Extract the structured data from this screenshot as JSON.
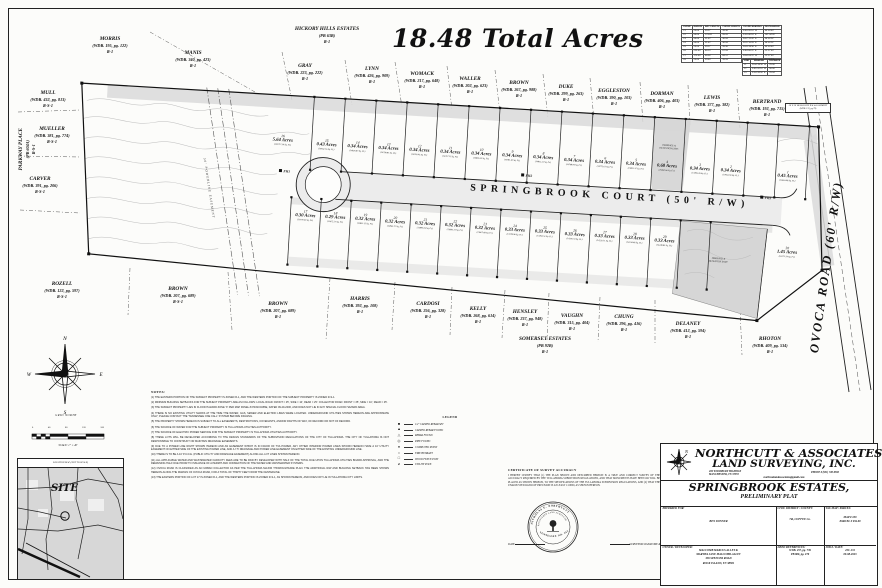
{
  "sheet": {
    "acres_title": "18.48 Total Acres"
  },
  "plat": {
    "street_label": "SPRINGBROOK COURT (50' R/W)",
    "road_label": "OVOCA ROAD (60' R/W)",
    "powerline_label": "50' POWERLINE EASEMENT",
    "bellsouth_note": "20' X 30' BELLSOUTH R/W & EASEMENT (WDB. 133, pg 79)",
    "detention_label_1": "DRAINAGE &",
    "detention_label_2": "DETENTION ESMT.",
    "lot4_esmt_1": "DRAINAGE &",
    "lot4_esmt_2": "DETENTION ESMT.",
    "hydrants": [
      {
        "label": "FH1",
        "x": 204,
        "y": 77
      },
      {
        "label": "FH2",
        "x": 446,
        "y": 67
      },
      {
        "label": "FH3",
        "x": 686,
        "y": 75
      }
    ],
    "north_lots": [
      {
        "num": "16",
        "acres": "5.64 Acres",
        "sqft": "(245717.36 Sq. Ft.)",
        "x": 206,
        "y": 42
      },
      {
        "num": "15",
        "acres": "0.43 Acres",
        "sqft": "(18652.16 Sq. Ft.)",
        "x": 250,
        "y": 44
      },
      {
        "num": "14",
        "acres": "0.34 Acres",
        "sqft": "(14826.87 Sq. Ft.)",
        "x": 281,
        "y": 44
      },
      {
        "num": "13",
        "acres": "0.34 Acres",
        "sqft": "(14799.81 Sq. Ft.)",
        "x": 312,
        "y": 44
      },
      {
        "num": "12",
        "acres": "0.34 Acres",
        "sqft": "(14790.43 Sq. Ft.)",
        "x": 343,
        "y": 44
      },
      {
        "num": "11",
        "acres": "0.34 Acres",
        "sqft": "(14757.11 Sq. Ft.)",
        "x": 374,
        "y": 44
      },
      {
        "num": "10",
        "acres": "0.34 Acres",
        "sqft": "(14806.55 Sq. Ft.)",
        "x": 405,
        "y": 44
      },
      {
        "num": "9",
        "acres": "0.34 Acres",
        "sqft": "(14781.40 Sq. Ft.)",
        "x": 436,
        "y": 44
      },
      {
        "num": "8",
        "acres": "0.34 Acres",
        "sqft": "(14812.22 Sq. Ft.)",
        "x": 467,
        "y": 44
      },
      {
        "num": "7",
        "acres": "0.34 Acres",
        "sqft": "(14768.94 Sq. Ft.)",
        "x": 498,
        "y": 45
      },
      {
        "num": "6",
        "acres": "0.34 Acres",
        "sqft": "(14775.61 Sq. Ft.)",
        "x": 529,
        "y": 45
      },
      {
        "num": "5",
        "acres": "0.34 Acres",
        "sqft": "(14802.37 Sq. Ft.)",
        "x": 560,
        "y": 45
      },
      {
        "num": "4",
        "acres": "0.68 Acres",
        "sqft": "(29490.66 Sq. Ft.)",
        "x": 591,
        "y": 45
      },
      {
        "num": "3",
        "acres": "0.34 Acres",
        "sqft": "(14785.09 Sq. Ft.)",
        "x": 624,
        "y": 46
      },
      {
        "num": "2",
        "acres": "0.34 Acres",
        "sqft": "(14952.93 Sq. Ft.)",
        "x": 655,
        "y": 46
      },
      {
        "num": "1",
        "acres": "0.45 Acres",
        "sqft": "(19663.98 Sq. Ft.)",
        "x": 712,
        "y": 48
      }
    ],
    "south_lots": [
      {
        "num": "17",
        "acres": "0.30 Acres",
        "sqft": "(13079.43 Sq. Ft.)",
        "x": 233,
        "y": 116
      },
      {
        "num": "18",
        "acres": "0.29 Acres",
        "sqft": "(12675.27 Sq. Ft.)",
        "x": 263,
        "y": 116
      },
      {
        "num": "19",
        "acres": "0.32 Acres",
        "sqft": "(13852.15 Sq. Ft.)",
        "x": 293,
        "y": 116
      },
      {
        "num": "20",
        "acres": "0.32 Acres",
        "sqft": "(13865.72 Sq. Ft.)",
        "x": 323,
        "y": 117
      },
      {
        "num": "21",
        "acres": "0.32 Acres",
        "sqft": "(13880.09 Sq. Ft.)",
        "x": 353,
        "y": 117
      },
      {
        "num": "22",
        "acres": "0.32 Acres",
        "sqft": "(13893.31 Sq. Ft.)",
        "x": 383,
        "y": 117
      },
      {
        "num": "23",
        "acres": "0.32 Acres",
        "sqft": "(13907.68 Sq. Ft.)",
        "x": 413,
        "y": 118
      },
      {
        "num": "24",
        "acres": "0.33 Acres",
        "sqft": "(14178.96 Sq. Ft.)",
        "x": 443,
        "y": 118
      },
      {
        "num": "25",
        "acres": "0.33 Acres",
        "sqft": "(14193.52 Sq. Ft.)",
        "x": 473,
        "y": 118
      },
      {
        "num": "26",
        "acres": "0.33 Acres",
        "sqft": "(14206.74 Sq. Ft.)",
        "x": 503,
        "y": 119
      },
      {
        "num": "27",
        "acres": "0.33 Acres",
        "sqft": "(14220.11 Sq. Ft.)",
        "x": 533,
        "y": 119
      },
      {
        "num": "28",
        "acres": "0.33 Acres",
        "sqft": "(14234.48 Sq. Ft.)",
        "x": 563,
        "y": 119
      },
      {
        "num": "29",
        "acres": "0.33 Acres",
        "sqft": "(14248.85 Sq. Ft.)",
        "x": 593,
        "y": 120
      },
      {
        "num": "30",
        "acres": "1.45 Acres",
        "sqft": "(63171.54 Sq. Ft.)",
        "x": 716,
        "y": 124
      }
    ],
    "neighbors": [
      {
        "name": "MORRIS",
        "ref": "(WDB. 195, pg. 122)",
        "zone": "R-1",
        "x": 110,
        "y": 36
      },
      {
        "name": "MANIS",
        "ref": "(WDB. 340, pg. 423)",
        "zone": "R-1",
        "x": 193,
        "y": 50
      },
      {
        "name": "HICKORY HILLS ESTATES",
        "ref": "(PB 63B)",
        "zone": "R-1",
        "x": 327,
        "y": 26
      },
      {
        "name": "GRAY",
        "ref": "(WDB. 223, pg. 222)",
        "zone": "R-1",
        "x": 305,
        "y": 63
      },
      {
        "name": "LYNN",
        "ref": "(WDB. 426, pg. 909)",
        "zone": "R-1",
        "x": 372,
        "y": 66
      },
      {
        "name": "WOMACK",
        "ref": "(WDB. 217, pg. 648)",
        "zone": "R-1",
        "x": 422,
        "y": 71
      },
      {
        "name": "WALLER",
        "ref": "(WDB. 202, pg. 623)",
        "zone": "R-1",
        "x": 470,
        "y": 76
      },
      {
        "name": "BROWN",
        "ref": "(WDB. 267, pg. 988)",
        "zone": "R-1",
        "x": 519,
        "y": 80
      },
      {
        "name": "DUKE",
        "ref": "(WDB. 299, pg. 263)",
        "zone": "R-1",
        "x": 566,
        "y": 84
      },
      {
        "name": "EGGLESTON",
        "ref": "(WDB. 390, pg. 103)",
        "zone": "R-1",
        "x": 614,
        "y": 88
      },
      {
        "name": "DORMAN",
        "ref": "(WDB. 406, pg. 403)",
        "zone": "R-1",
        "x": 662,
        "y": 91
      },
      {
        "name": "LEWIS",
        "ref": "(WDB. 377, pg. 382)",
        "zone": "R-1",
        "x": 712,
        "y": 95
      },
      {
        "name": "BERTRAND",
        "ref": "(WDB. 192, pg. 715)",
        "zone": "R-1",
        "x": 767,
        "y": 99
      },
      {
        "name": "MULL",
        "ref": "(WDB. 432, pg. 813)",
        "zone": "R-S-1",
        "x": 48,
        "y": 90
      },
      {
        "name": "MUELLER",
        "ref": "(WDB. 381, pg. 774)",
        "zone": "R-S-1",
        "x": 52,
        "y": 126
      },
      {
        "name": "PARKWAY PLACE",
        "ref": "(PB 604A)",
        "zone": "R-S-1",
        "x": 27,
        "y": 140,
        "rot": -90
      },
      {
        "name": "CARVER",
        "ref": "(WDB. 391, pg. 206)",
        "zone": "R-S-1",
        "x": 40,
        "y": 176
      },
      {
        "name": "ROZELL",
        "ref": "(WDB. 122, pg. 597)",
        "zone": "R-S-1",
        "x": 62,
        "y": 281
      },
      {
        "name": "BROWN",
        "ref": "(WDB. 207, pg. 689)",
        "zone": "R-S-1",
        "x": 178,
        "y": 286
      },
      {
        "name": "BROWN",
        "ref": "(WDB. 207, pg. 689)",
        "zone": "R-1",
        "x": 278,
        "y": 301
      },
      {
        "name": "HARRIS",
        "ref": "(WDB. 392, pg. 108)",
        "zone": "R-1",
        "x": 360,
        "y": 296
      },
      {
        "name": "CARDOSI",
        "ref": "(WDB. 256, pg. 328)",
        "zone": "R-1",
        "x": 428,
        "y": 301
      },
      {
        "name": "KELLY",
        "ref": "(WDB. 268, pg. 614)",
        "zone": "R-1",
        "x": 478,
        "y": 306
      },
      {
        "name": "HENSLEY",
        "ref": "(WDB. 237, pg. 948)",
        "zone": "R-1",
        "x": 525,
        "y": 309
      },
      {
        "name": "VAUGHN",
        "ref": "(WDB. 315, pg. 404)",
        "zone": "R-1",
        "x": 572,
        "y": 313
      },
      {
        "name": "CHUNG",
        "ref": "(WDB. 296, pg. 416)",
        "zone": "R-1",
        "x": 624,
        "y": 314
      },
      {
        "name": "DELANEY",
        "ref": "(WDB. 412, pg. 594)",
        "zone": "R-1",
        "x": 688,
        "y": 321
      },
      {
        "name": "SOMERSET ESTATES",
        "ref": "(PB 92B)",
        "zone": "R-1",
        "x": 545,
        "y": 336
      },
      {
        "name": "RHOTON",
        "ref": "(WDB. 409, pg. 534)",
        "zone": "R-1",
        "x": 770,
        "y": 336
      }
    ]
  },
  "curve_table": {
    "headers": [
      "CURVE",
      "RADIUS",
      "ARC LENGTH",
      "CHORD LENGTH",
      "CHORD BEARING",
      "DELTA ANGLE"
    ],
    "rows": [
      [
        "C1",
        "25.00'",
        "39.27'",
        "35.36'",
        "S 40°20'10\" W",
        "90°00'00\""
      ],
      [
        "C2",
        "50.00'",
        "123.69'",
        "95.26'",
        "S 30°40'18\" E",
        "141°44'28\""
      ],
      [
        "C3",
        "50.00'",
        "31.42'",
        "30.94'",
        "N 67°12'42\" E",
        "36°00'24\""
      ],
      [
        "C4",
        "50.00'",
        "31.42'",
        "30.94'",
        "N 31°10'05\" E",
        "36°00'24\""
      ],
      [
        "C5",
        "25.00'",
        "39.27'",
        "35.36'",
        "N 49°39'50\" E",
        "90°00'00\""
      ],
      [
        "C6",
        "225.00'",
        "88.15'",
        "87.59'",
        "S 84°06'22\" E",
        "22°27'00\""
      ],
      [
        "C7",
        "175.00'",
        "68.56'",
        "68.12'",
        "N 84°06'22\" W",
        "22°27'00\""
      ],
      [
        "C8",
        "25.00'",
        "39.60'",
        "35.59'",
        "S 41°05'16\" E",
        "90°45'30\""
      ]
    ]
  },
  "line_table": {
    "headers": [
      "LINE",
      "BEARING",
      "DISTANCE"
    ],
    "rows": [
      [
        "L1",
        "N 04°39'50\" W",
        "25.00'"
      ],
      [
        "L2",
        "S 85°20'10\" W",
        "50.00'"
      ],
      [
        "L3",
        "S 04°39'50\" E",
        "25.04'"
      ]
    ]
  },
  "compass": {
    "n": "N",
    "e": "E",
    "s": "S",
    "w": "W",
    "caption": "GRID NORTH"
  },
  "scale_bar": {
    "ticks": [
      "0",
      "40",
      "80",
      "120",
      "160"
    ],
    "caption": "SCALE: 1\" = 40'"
  },
  "location_map": {
    "header": "LOCATION MAP (NOT TO SCALE)",
    "site": "SITE"
  },
  "notes": {
    "header": "NOTES:",
    "items": [
      "(1)  THE EASTERN PORTION OF THE SUBJECT PROPERTY IS ZONED R-1, AND THE WESTERN PORTION OF THE SUBJECT PROPERTY IS ZONED R-S-1.",
      "(2)  MINIMUM BUILDING SETBACKS FOR THE SUBJECT PROPERTY ARE AS FOLLOWS:  LOCAL ROAD:  FRONT = 25', SIDE = 10', REAR = 25'.  COLLECTOR ROAD:  FRONT = 35', SIDE = 10', REAR = 25'.",
      "(3)  THE SUBJECT PROPERTY LIES IN FLOOD HAZARD ZONE 'X' PER MAP PANEL #47031C0465E, DATED 09-29-2006, AND DOES NOT LIE IN ANY SPECIAL FLOOD HAZARD AREA.",
      "(4)  THERE IS NO EXISTING UTILITY MARKS AT THE TIME THE WATER, GAS, SEWER AND ELECTRIC LINES WERE LOCATED. UNDERGROUND UTILITIES SHOWN HEREON ARE APPROXIMATE ONLY; PLEASE CONTACT THE 'TENNESSEE ONE CALL' SYSTEM BEFORE DIGGING.",
      "(5)  THE PROPERTY SHOWN HEREON IS SUBJECT TO ALL EASEMENTS, RESTRICTIONS, COVENANTS, AND/OR RIGHTS OF WAY, OF RECORD OR NOT OF RECORD.",
      "(6)  THE SOURCE OF WATER FOR THE SUBJECT PROPERTY IS TULLAHOMA UTILITIES AUTHORITY.",
      "(7)  THE SOURCE OF ELECTRIC POWER SERVICE FOR THE SUBJECT PROPERTY IS TULLAHOMA UTILITIES AUTHORITY.",
      "(8)  THESE LOTS WILL BE DEVELOPED ACCORDING TO THE DESIGN STANDARDS OF THE SUBDIVISION REGULATIONS OF THE CITY OF TULLAHOMA. THE CITY OF TULLAHOMA IS NOT RESPONSIBLE TO CONSTRUCT OR MAINTAIN DRAINAGE EASEMENTS.",
      "(9)  DUE TO A POWER LINE RIGHT SHOWN HEREON AND AN EASEMENT WHICH IS IN FAVOR OF TVA POWER, ANY OTHER INTERIOR POWER LINES SHOWN HEREON HAVE A 10' UTILITY EASEMENT ON EITHER SIDE OF THE EXISTING POWER LINE, AND A 7.5' DRAINAGE AND POWER LINE EASEMENT ON EITHER SIDE OF THE EXISTING UNDERGROUND LINE.",
      "(10)  THERE IS TO BE A 10' P.U.D.E. (PUBLIC UTILITY AND DRAINAGE EASEMENT) ALONG ALL LOT LINES SHOWN HEREON.",
      "(11)  ALL APPLICABLE WATER AND WASTEWATER CAPACITY FEES ARE TO BE PAID BY DEVELOPER WITH HALF OF THE TOTAL DUE UPON TULLAHOMA UTILITIES BOARD APPROVAL, AND THE REMAINING HALF DUE PRIOR TO ISSUANCE OF A PERMIT AND CONNECTION OF THE WATER AND WASTEWATER SYSTEMS.",
      "(12)  OVOCA ROAD IS CLASSIFIED AS AN URBAN COLLECTOR AS PER THE TULLAHOMA MAJOR THOROUGHFARE PLAN. THE ADDITIONAL R/W AND BUILDING SETBACK HAS BEEN SHOWN HEREON ALONG THE MARGIN OF OVOCA ROAD, FOR A TOTAL OF THIRTY FEET FROM THE CENTERLINE.",
      "(13)  THE EASTERN PORTION OF LOT 17 IS ZONED R-1, AND THE WESTERN PORTION IS ZONED R-S-1, AS SHOWN HEREON, AND DOES NOT LIE IN TULLAHOMA CITY LIMITS."
    ]
  },
  "legend": {
    "header": "LEGEND",
    "items": [
      {
        "symbol": "■",
        "label": "1/2\" CAPPED REBAR SET"
      },
      {
        "symbol": "▲",
        "label": "CAPPED REBAR FOUND"
      },
      {
        "symbol": "△",
        "label": "REBAR FOUND"
      },
      {
        "symbol": "◎",
        "label": "PIPE FOUND"
      },
      {
        "symbol": "●",
        "label": "COMPUTED POINT"
      },
      {
        "symbol": "○",
        "label": "FIRE HYDRANT"
      },
      {
        "symbol": "□",
        "label": "WOOD FENCE POST"
      },
      {
        "symbol": "⌀",
        "label": "UTILITY POLE"
      }
    ]
  },
  "certification": {
    "title": "CERTIFICATE OF SURVEY ACCURACY",
    "body": "I HEREBY CERTIFY THAT (1) THE PLAN SHOWN AND DESCRIBED HEREON IS A TRUE AND CORRECT SURVEY OF THE ACCURACY REQUIRED BY THE TULLAHOMA SUBDIVISION REGULATIONS, AND THAT MONUMENTS HAVE BEEN OR WILL BE PLACED AS SHOWN HEREON, TO THE SPECIFICATIONS OF THE TULLAHOMA SUBDIVISION REGULATIONS, AND (2) THAT THE UNADJUSTED RATIO OF PRECISION IS AT LEAST 1:10000, AS SHOWN HEREON.",
    "date_label": "DATE",
    "signature_label": "SURVEYOR SIGNATURE & LIC. #"
  },
  "seal": {
    "name": "NICHOLAS E. NORTHCUTT",
    "title": "REGISTERED LAND SURVEYOR",
    "bottom": "TENNESSEE NO. 2633"
  },
  "title_block": {
    "company_line1": "NORTHCUTT & ASSOCIATES",
    "company_line2": "LAND SURVEYING, INC.",
    "address1": "409 WOODBURY HIGHWAY",
    "address2": "MANCHESTER, TN  37355",
    "phone": "PHONE # (931) 728-9500",
    "email": "northcuttandassociates@gmail.com",
    "project": "SPRINGBROOK ESTATES,",
    "subtitle": "PRELIMINARY PLAT",
    "prepared_for_label": "PREPARED FOR:",
    "prepared_for": "BEN DONNER",
    "district_label": "CIVIL DISTRICT / COUNTY:",
    "district": "7th, COFFEE Co.",
    "taxmap_label": "TAX MAP / PARCEL:",
    "taxmap": "MAP # 109",
    "parcel": "PARCEL # 034.00",
    "owner_label": "OWNER / DEVELOPER:",
    "owner_lines": [
      "MALCOMB MARCUS ALLEY &",
      "MARTHA JANE MALCOMB-ALLEY",
      "336 SPENCER ROAD",
      "ROCK ISLAND, TN 38581"
    ],
    "deed_label": "DEED REFERENCES:",
    "deed_lines": [
      "WDB. 457, pg. 739",
      "PB 860, pg. 276"
    ],
    "job_label": "JOB # / DATE:",
    "job_lines": [
      "23C-131",
      "09-08-2023"
    ]
  }
}
